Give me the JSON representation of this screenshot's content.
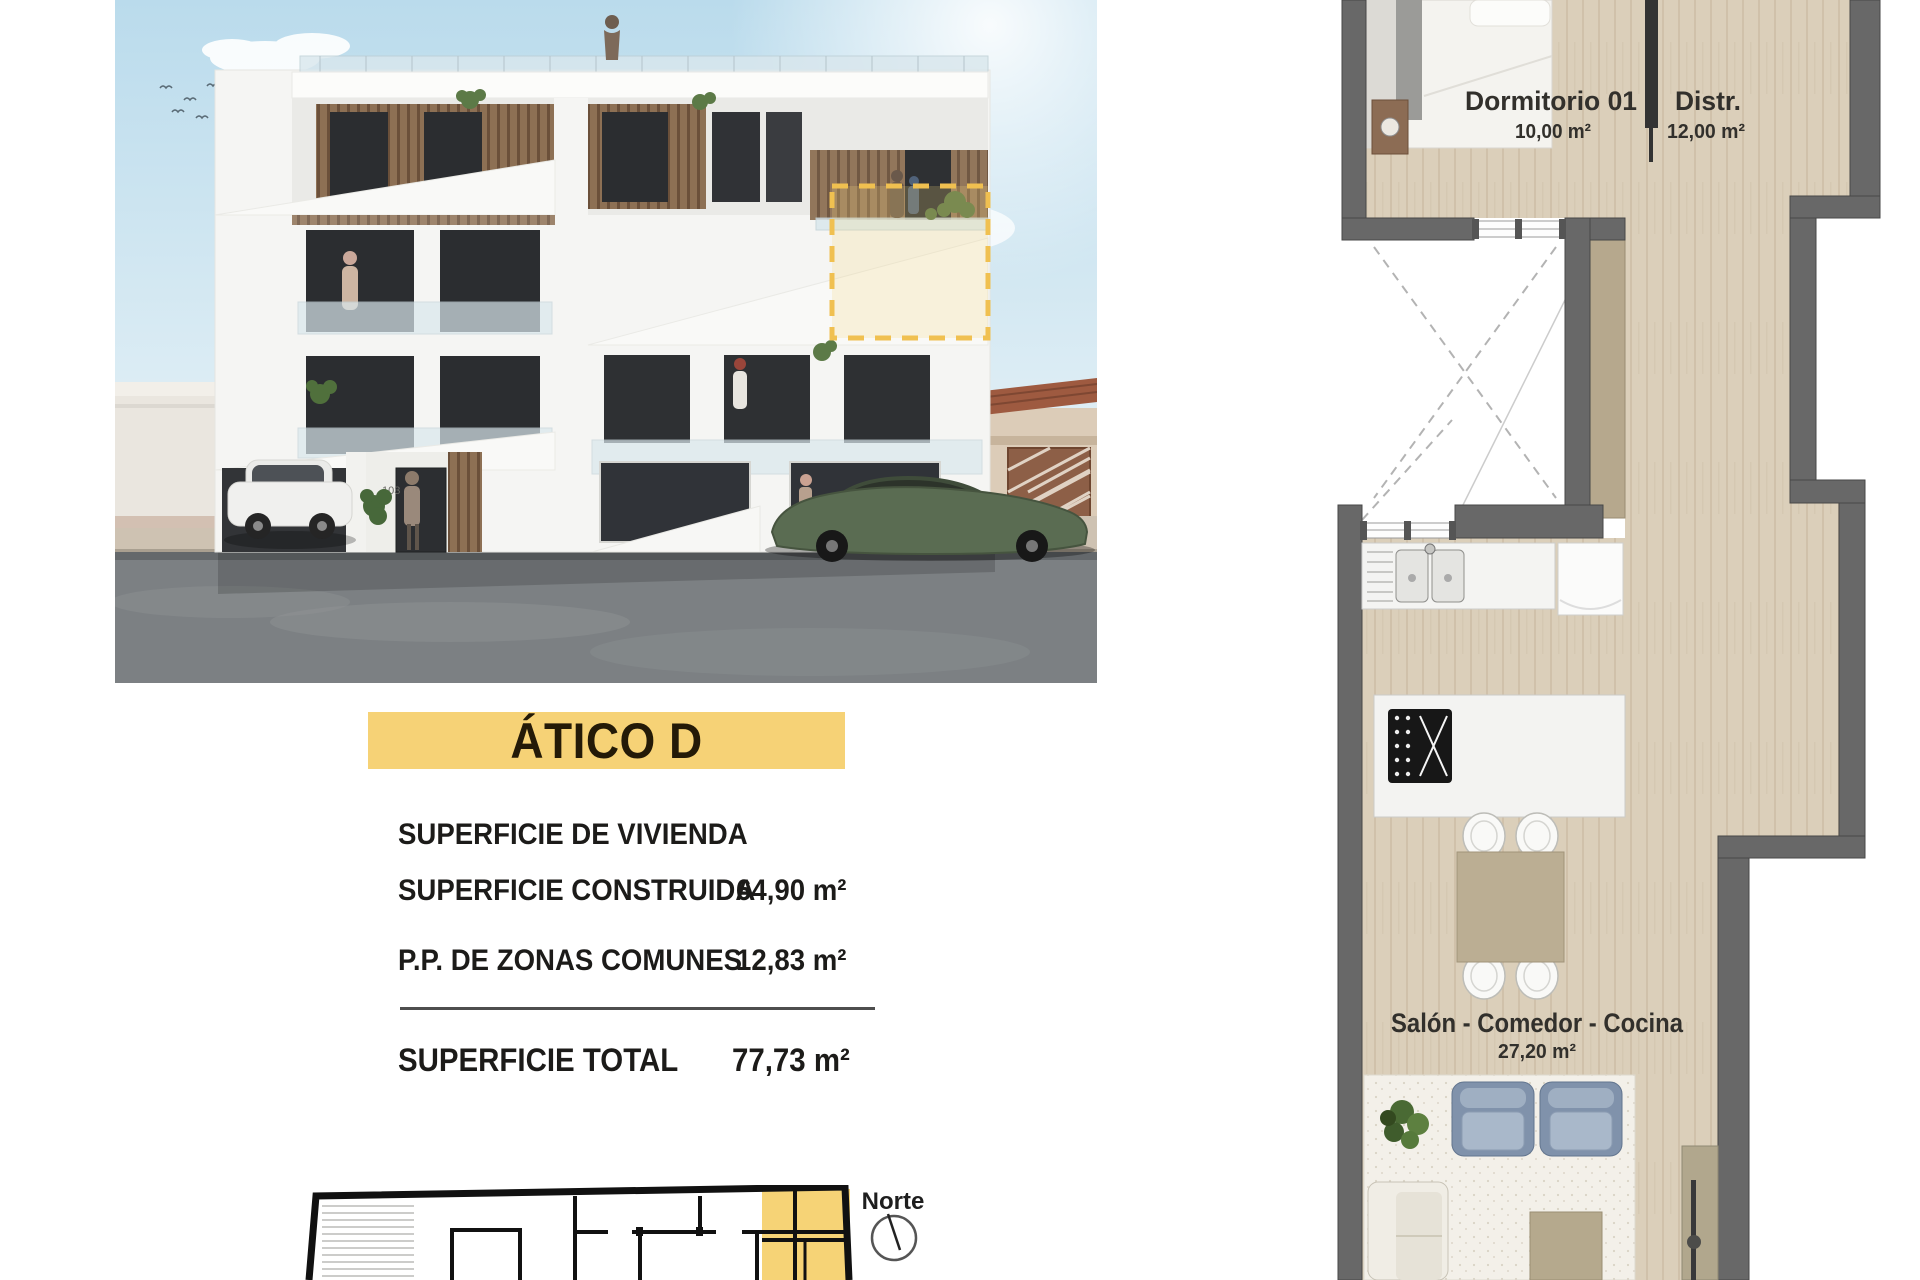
{
  "unit": {
    "name": "ÁTICO D"
  },
  "surfaces": {
    "section_title": "SUPERFICIE DE VIVIENDA",
    "rows": [
      {
        "label": "SUPERFICIE CONSTRUIDA",
        "value": "64,90 m²"
      },
      {
        "label": "P.P. DE ZONAS COMUNES",
        "value": "12,83 m²"
      }
    ],
    "total_label": "SUPERFICIE TOTAL",
    "total_value": "77,73 m²"
  },
  "floor_plan": {
    "rooms": [
      {
        "name": "Dormitorio 01",
        "area": "10,00 m²"
      },
      {
        "name": "Distr.",
        "area": "12,00 m²"
      },
      {
        "name": "Salón - Comedor - Cocina",
        "area": "27,20 m²"
      }
    ]
  },
  "key_plan": {
    "north_label": "Norte"
  },
  "building": {
    "door_number": "103"
  },
  "colors": {
    "accent_yellow": "#f6d276",
    "wall_grey": "#686868",
    "wood": "#dbcfba",
    "ink": "#1c1b19"
  }
}
